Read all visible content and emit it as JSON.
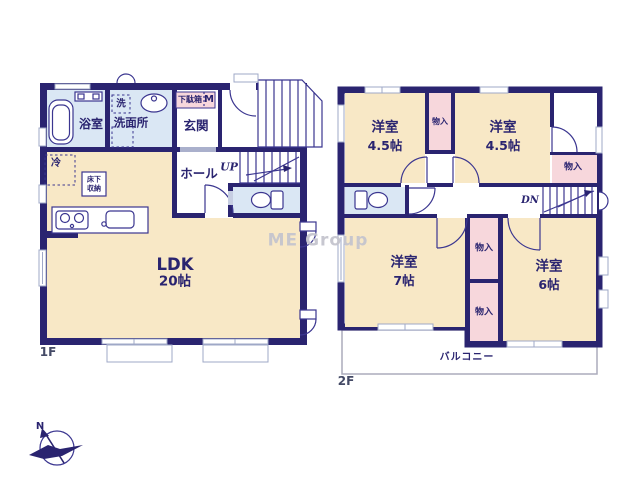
{
  "watermark": "ME Group",
  "compass": {
    "north_label": "N"
  },
  "colors": {
    "wall": "#2A2470",
    "room": "#F8E8C6",
    "closet": "#F7D7DC",
    "water": "#DAE7F4",
    "line": "#3B3690",
    "window": "#9FA8C7",
    "balcony_border": "#ABABBC",
    "text": "#2A2470",
    "muted_text": "#444A66",
    "watermark": "#C5C5CE"
  },
  "floor1": {
    "label": "1F",
    "bathroom": "浴室",
    "washer": "洗",
    "washroom": "洗面所",
    "shoe_cabinet": "下駄箱",
    "meter": "M",
    "entrance": "玄関",
    "hall": "ホール",
    "stairs_up": "UP",
    "fridge": "冷",
    "floor_storage": [
      "床下",
      "収納"
    ],
    "ldk_name": "LDK",
    "ldk_size": "20帖"
  },
  "floor2": {
    "label": "2F",
    "rooms": [
      {
        "name": "洋室",
        "size": "4.5帖"
      },
      {
        "name": "洋室",
        "size": "4.5帖"
      },
      {
        "name": "洋室",
        "size": "7帖"
      },
      {
        "name": "洋室",
        "size": "6帖"
      }
    ],
    "closet": "物入",
    "stairs_down": "DN",
    "balcony": "バルコニー"
  }
}
